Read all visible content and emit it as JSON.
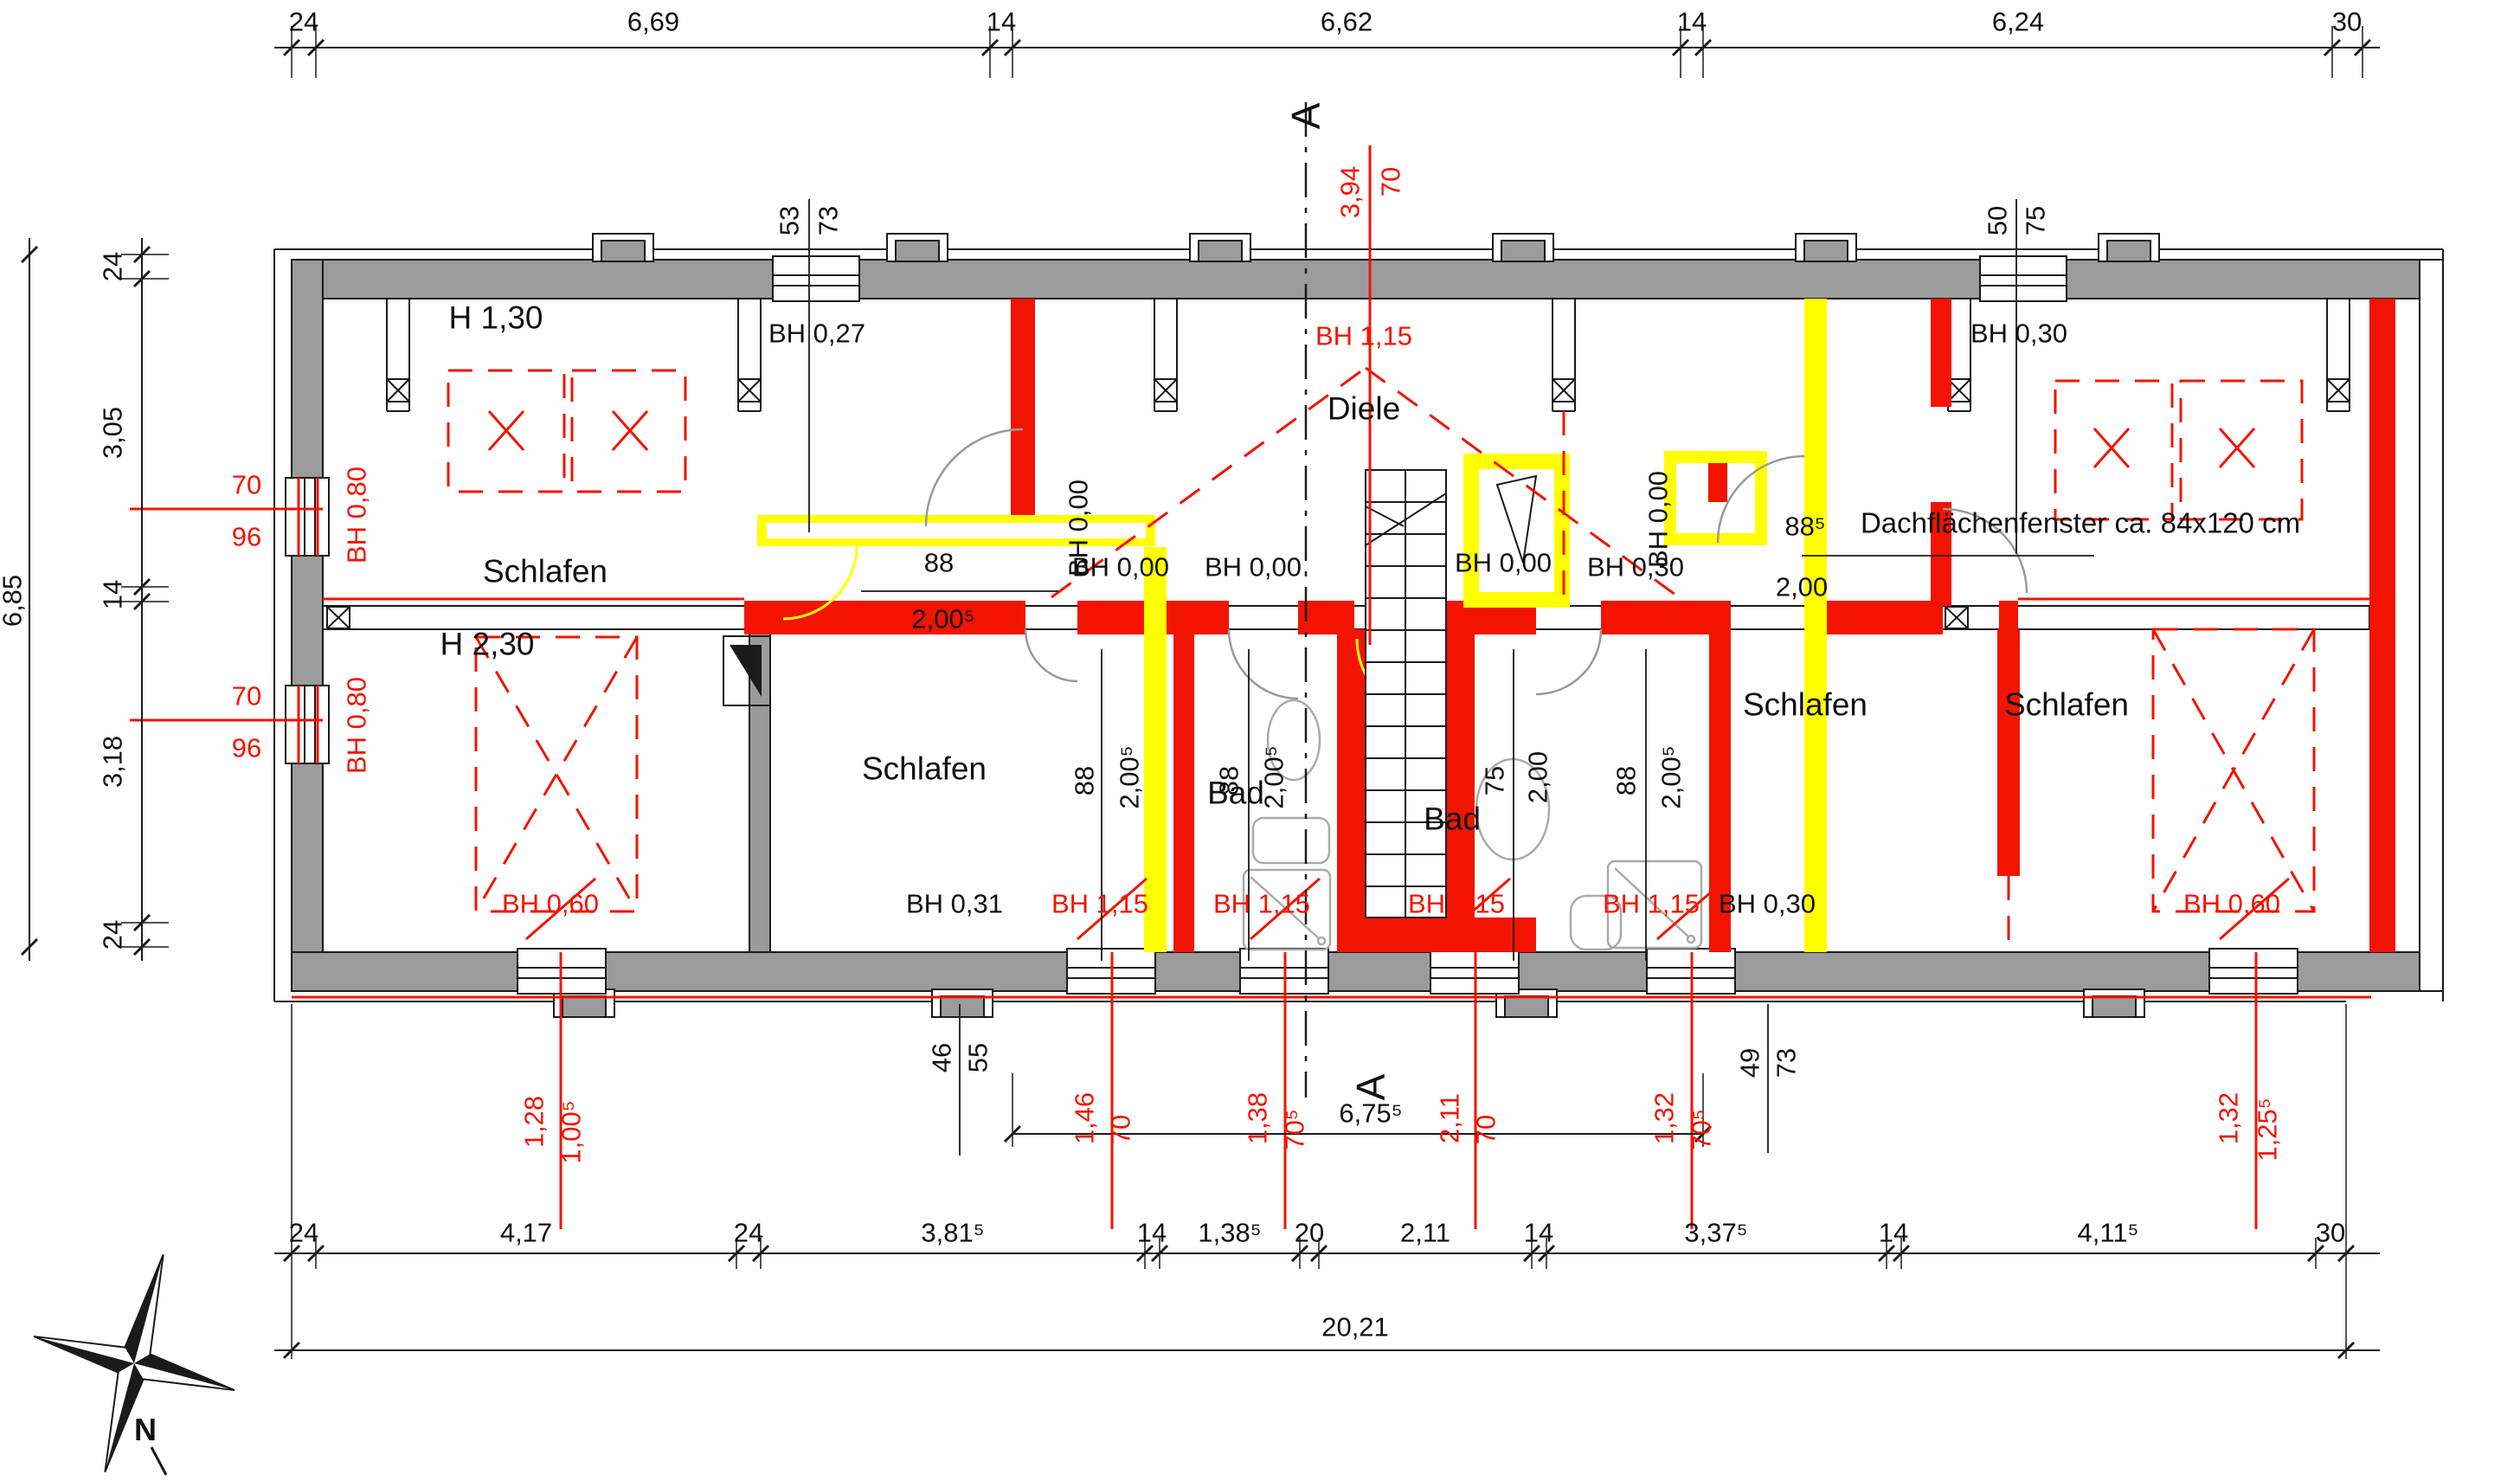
{
  "plan": {
    "rooms": {
      "schlafen": [
        "Schlafen",
        "Schlafen",
        "Schlafen",
        "Schlafen",
        "Schlafen"
      ],
      "diele": "Diele",
      "bad": [
        "Bad",
        "Bad"
      ]
    },
    "heights": {
      "top_left": "H 1,30",
      "bottom_left": "H 2,30"
    },
    "note": "Dachflächenfenster ca. 84x120 cm",
    "section_marker": "A",
    "compass_north": "N",
    "colors": {
      "new_wall_red": "#f21400",
      "demolition_yellow": "#ffff00",
      "existing_gray": "#9b9b9b"
    }
  },
  "sill_heights": {
    "black": {
      "bh_027": "BH 0,27",
      "bh_030_top": "BH 0,30",
      "bh_030_mid": "BH 0,30",
      "bh_031": "BH 0,31",
      "bh_030_bottom": "BH 0,30",
      "bh_000": [
        "BH 0,00",
        "BH 0,00",
        "BH 0,00",
        "BH 0,00",
        "BH 0,00",
        "BH 0,00"
      ]
    },
    "red": {
      "bh_115_top": "BH 1,15",
      "bh_115_bottom": [
        "BH 1,15",
        "BH 1,15",
        "BH 1,15",
        "BH 1,15"
      ],
      "bh_060": [
        "BH 0,60",
        "BH 0,60"
      ],
      "bh_080": [
        "BH 0,80",
        "BH 0,80"
      ]
    }
  },
  "doors": {
    "top_left": [
      "88",
      "2,00⁵"
    ],
    "top_right": [
      "88⁵",
      "2,00"
    ],
    "lower": [
      [
        "88",
        "2,00⁵"
      ],
      [
        "88",
        "2,00⁵"
      ],
      [
        "75",
        "2,00"
      ],
      [
        "88",
        "2,00⁵"
      ]
    ]
  },
  "windows": {
    "left": [
      [
        "70",
        "96"
      ],
      [
        "70",
        "96"
      ]
    ],
    "roof_top": [
      "3,94",
      "70"
    ],
    "top_black": [
      [
        "53",
        "73"
      ],
      [
        "50",
        "75"
      ]
    ],
    "bottom_black": [
      [
        "46",
        "55"
      ],
      [
        "49",
        "73"
      ]
    ],
    "bottom_red": [
      [
        "1,28",
        "1,00⁵"
      ],
      [
        "1,46",
        "70"
      ],
      [
        "1,38",
        "70⁵"
      ],
      [
        "2,11",
        "70"
      ],
      [
        "1,32",
        "70⁵"
      ],
      [
        "1,32",
        "1,25⁵"
      ]
    ]
  },
  "dims": {
    "top_chain": [
      "24",
      "6,69",
      "14",
      "6,62",
      "14",
      "6,24",
      "30"
    ],
    "left_chain": [
      "24",
      "3,05",
      "14",
      "3,18",
      "24"
    ],
    "left_total": "6,85",
    "bottom_chain": [
      "24",
      "4,17",
      "24",
      "3,81⁵",
      "14",
      "1,38⁵",
      "20",
      "2,11",
      "14",
      "3,37⁵",
      "14",
      "4,11⁵",
      "30"
    ],
    "bottom_partial": "6,75⁵",
    "bottom_total": "20,21"
  }
}
